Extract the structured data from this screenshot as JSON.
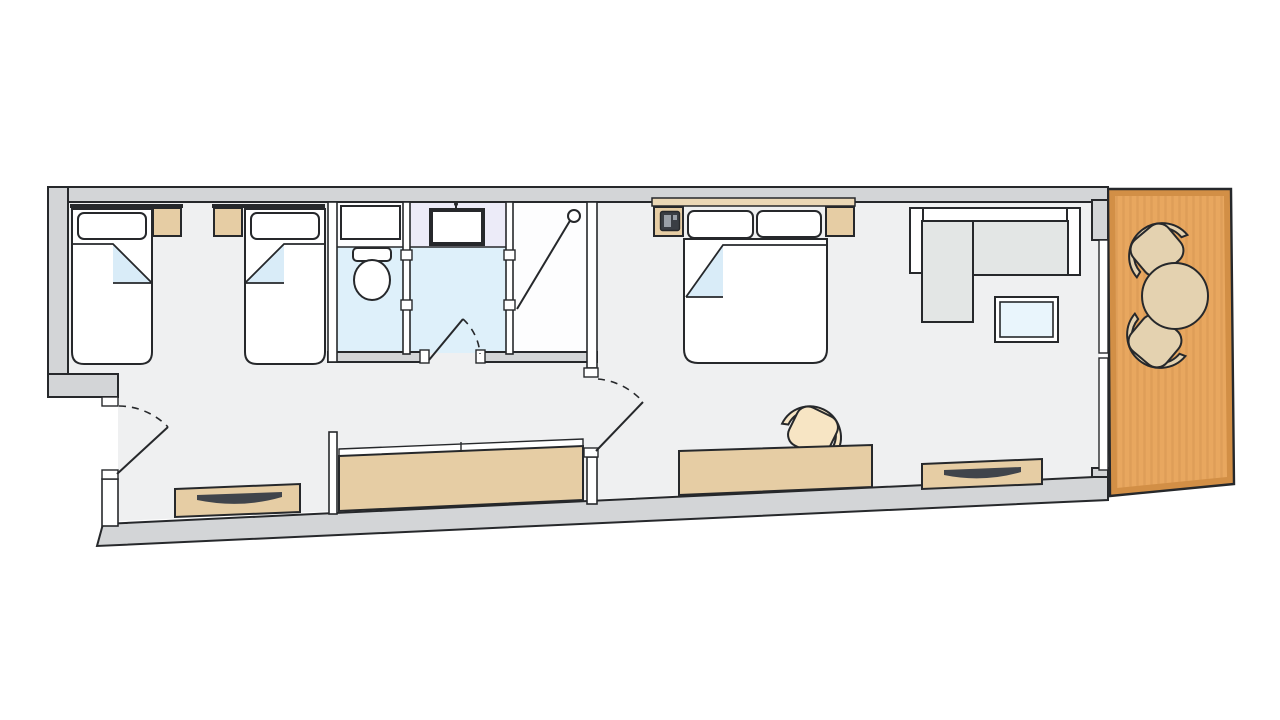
{
  "plan": {
    "kind": "hotel-suite-floor-plan",
    "rooms": [
      {
        "name": "twin-bedroom",
        "furniture": [
          "single-bed-1",
          "single-bed-2",
          "nightstand-1",
          "nightstand-2",
          "headboard-1",
          "headboard-2"
        ]
      },
      {
        "name": "bathroom-wc",
        "furniture": [
          "toilet",
          "wc-shelf"
        ]
      },
      {
        "name": "bathroom-core",
        "furniture": [
          "washbasin",
          "faucet"
        ]
      },
      {
        "name": "shower-cabin",
        "furniture": [
          "shower-door",
          "shower-head"
        ]
      },
      {
        "name": "corridor",
        "furniture": [
          "entry-dresser",
          "wardrobe"
        ]
      },
      {
        "name": "master-bedroom",
        "furniture": [
          "double-bed",
          "nightstand-left",
          "nightstand-right",
          "phone",
          "desk",
          "desk-chair",
          "low-dresser"
        ]
      },
      {
        "name": "living-area",
        "furniture": [
          "corner-sofa",
          "coffee-table"
        ]
      },
      {
        "name": "balcony",
        "furniture": [
          "patio-table",
          "patio-chair-top",
          "patio-chair-bottom"
        ]
      }
    ],
    "doors": [
      "entry-door",
      "bathroom-door",
      "bedroom-door"
    ],
    "windows": [
      "balcony-glass-door"
    ]
  },
  "colors": {
    "white": "#ffffff",
    "wall_fill": "#d3d5d7",
    "wall_outline": "#26282b",
    "floor_room": "#eff0f1",
    "floor_bathroom": "#def0fa",
    "vanity_zone": "#ecebf8",
    "floor_shower": "#fdfdfe",
    "furniture_wood": "#e6cda4",
    "headboard_wood": "#ebd8b6",
    "blanket_fold": "#d9ecf8",
    "sofa_fabric": "#e3e6e5",
    "table_glass": "#e9f5fc",
    "balcony_deck": "#e8a75f",
    "balcony_deck_border": "#d28f46",
    "outdoor_furniture": "#e4d2b0",
    "chair_cream": "#f7e5c4",
    "handle_metal": "#40444b",
    "device_dark": "#3a3e44",
    "device_light": "#9aa0a8"
  }
}
